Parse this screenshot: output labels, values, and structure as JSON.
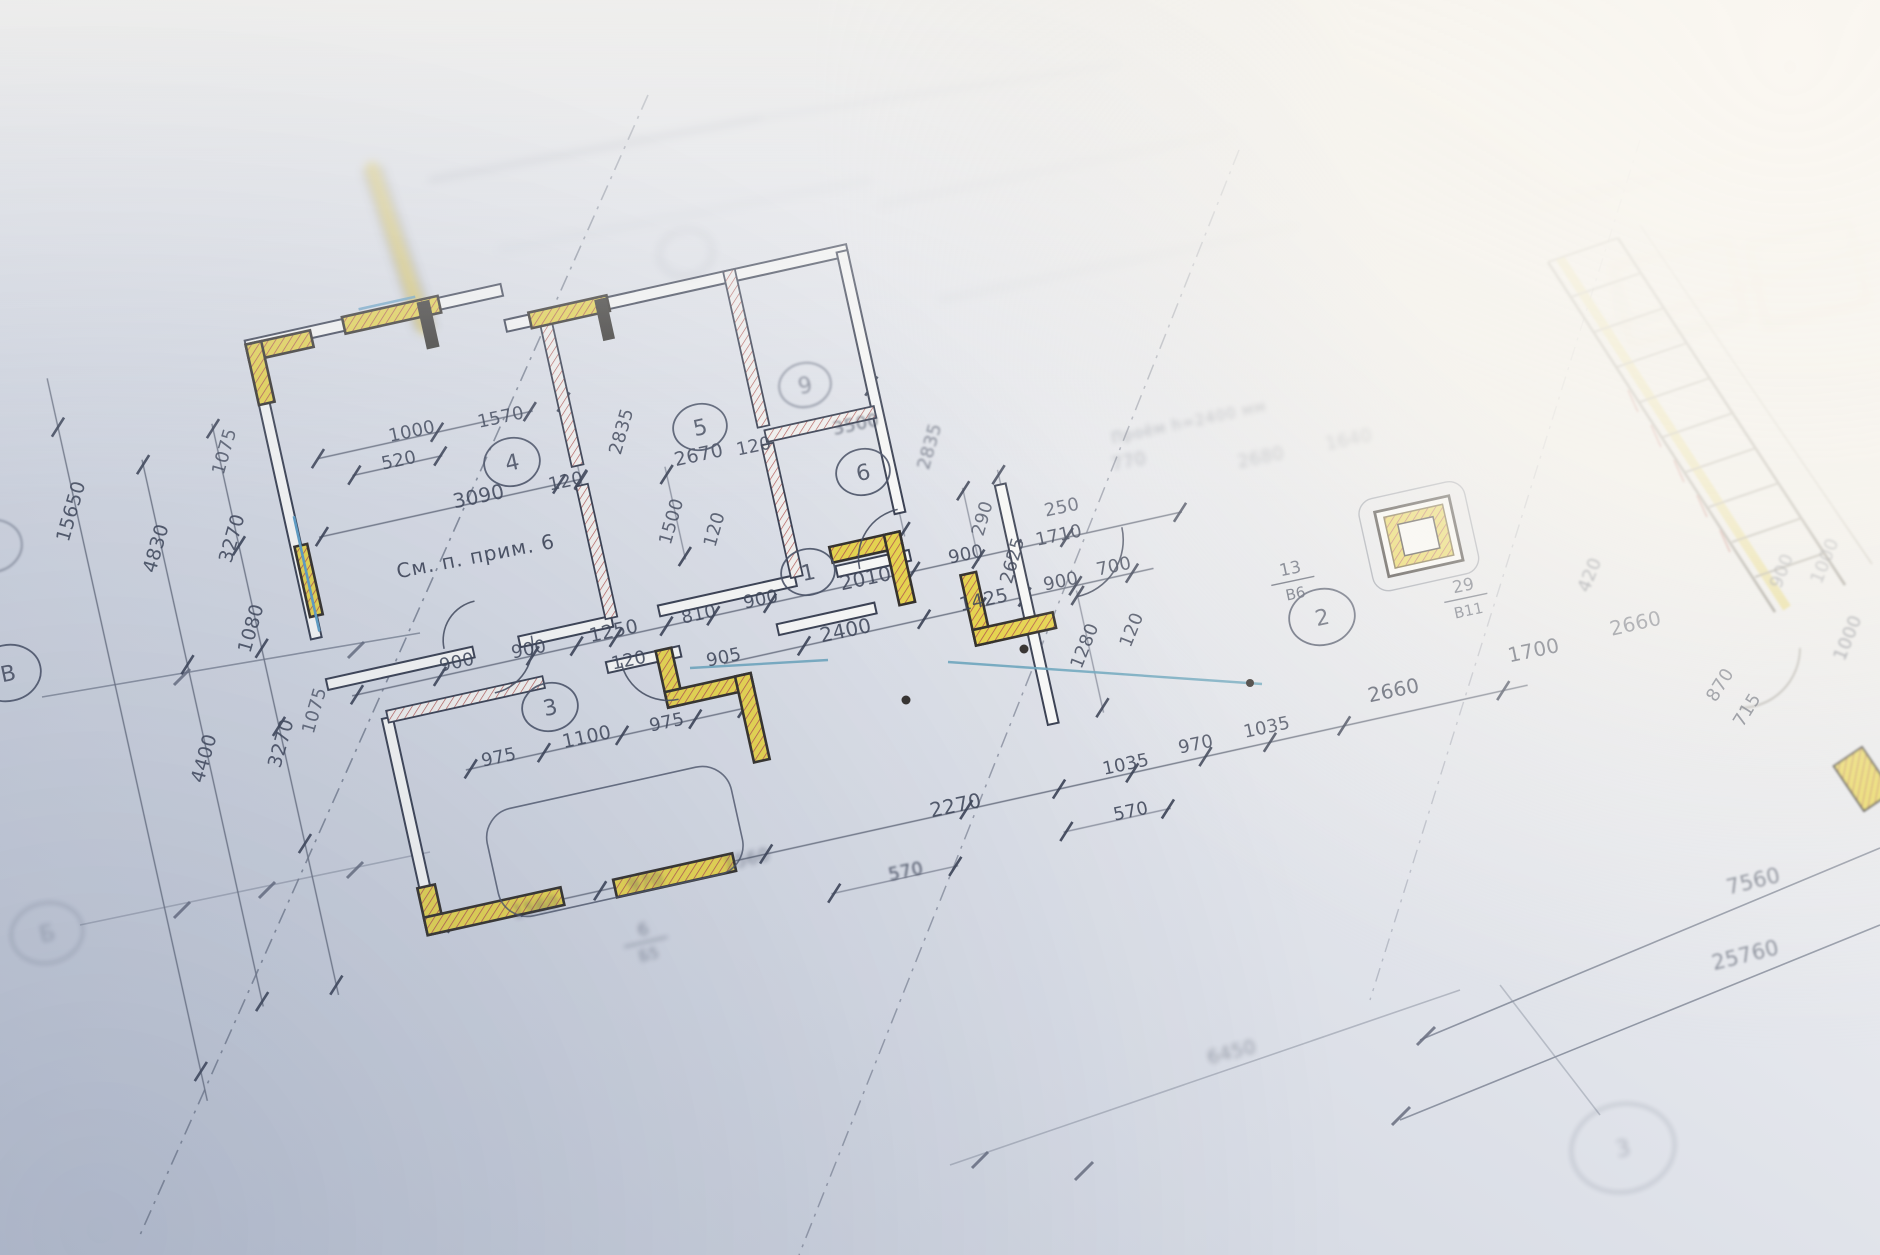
{
  "palette": {
    "paper_dark": "#c3c9d6",
    "paper_mid": "#dde0e8",
    "paper_light": "#f6f4ee",
    "line_dark": "#353b4c",
    "line_mid": "#5a6274",
    "wall_yellow": "#ead74e",
    "hatch_red": "#b3524d",
    "window_blue": "#5e9fc6",
    "accent_tan": "#c8a85a"
  },
  "plan": {
    "dimension_labels": [
      {
        "t": "1000",
        "x": 413,
        "y": 437,
        "r": -12
      },
      {
        "t": "1570",
        "x": 502,
        "y": 423,
        "r": -12
      },
      {
        "t": "520",
        "x": 400,
        "y": 466,
        "r": -12
      },
      {
        "t": "3090",
        "x": 480,
        "y": 503,
        "r": -12,
        "s": 20
      },
      {
        "t": "120",
        "x": 567,
        "y": 487,
        "r": -12
      },
      {
        "t": "2670",
        "x": 700,
        "y": 461,
        "r": -12,
        "s": 19
      },
      {
        "t": "120",
        "x": 755,
        "y": 452,
        "r": -12
      },
      {
        "t": "3500",
        "x": 857,
        "y": 430,
        "r": -12,
        "o": 0.7,
        "b": 1
      },
      {
        "t": "2835",
        "x": 627,
        "y": 433,
        "r": -74
      },
      {
        "t": "2835",
        "x": 935,
        "y": 448,
        "r": -74,
        "o": 0.6,
        "b": 1
      },
      {
        "t": "1500",
        "x": 677,
        "y": 523,
        "r": -74,
        "o": 0.8
      },
      {
        "t": "120",
        "x": 720,
        "y": 531,
        "r": -74,
        "o": 0.8
      },
      {
        "t": "2010",
        "x": 867,
        "y": 585,
        "r": -12,
        "s": 20
      },
      {
        "t": "900",
        "x": 762,
        "y": 605,
        "r": -12
      },
      {
        "t": "810",
        "x": 700,
        "y": 620,
        "r": -12
      },
      {
        "t": "1250",
        "x": 615,
        "y": 637,
        "r": -12,
        "s": 19
      },
      {
        "t": "120",
        "x": 630,
        "y": 666,
        "r": -12
      },
      {
        "t": "905",
        "x": 725,
        "y": 663,
        "r": -12
      },
      {
        "t": "2400",
        "x": 847,
        "y": 637,
        "r": -12,
        "s": 20
      },
      {
        "t": "900",
        "x": 458,
        "y": 668,
        "r": -12
      },
      {
        "t": "900",
        "x": 530,
        "y": 655,
        "r": -12
      },
      {
        "t": "975",
        "x": 500,
        "y": 763,
        "r": -12
      },
      {
        "t": "1100",
        "x": 588,
        "y": 743,
        "r": -12,
        "s": 19
      },
      {
        "t": "975",
        "x": 668,
        "y": 728,
        "r": -12
      },
      {
        "t": "250",
        "x": 1063,
        "y": 513,
        "r": -12,
        "o": 0.75
      },
      {
        "t": "1710",
        "x": 1060,
        "y": 541,
        "r": -12
      },
      {
        "t": "900",
        "x": 967,
        "y": 560,
        "r": -12
      },
      {
        "t": "2625",
        "x": 1018,
        "y": 562,
        "r": -74
      },
      {
        "t": "290",
        "x": 988,
        "y": 520,
        "r": -74,
        "o": 0.75
      },
      {
        "t": "1425",
        "x": 985,
        "y": 606,
        "r": -12,
        "s": 19
      },
      {
        "t": "900",
        "x": 1062,
        "y": 587,
        "r": -12
      },
      {
        "t": "700",
        "x": 1115,
        "y": 572,
        "r": -12
      },
      {
        "t": "1280",
        "x": 1090,
        "y": 648,
        "r": -68
      },
      {
        "t": "120",
        "x": 1137,
        "y": 632,
        "r": -68
      },
      {
        "t": "2660",
        "x": 1395,
        "y": 697,
        "r": -12,
        "s": 20
      },
      {
        "t": "1700",
        "x": 1535,
        "y": 657,
        "r": -12,
        "s": 20
      },
      {
        "t": "1035",
        "x": 1268,
        "y": 733,
        "r": -12
      },
      {
        "t": "1035",
        "x": 1127,
        "y": 770,
        "r": -12
      },
      {
        "t": "970",
        "x": 1197,
        "y": 750,
        "r": -12
      },
      {
        "t": "2270",
        "x": 957,
        "y": 812,
        "r": -12,
        "s": 20
      },
      {
        "t": "570",
        "x": 1132,
        "y": 817,
        "r": -12
      },
      {
        "t": "570",
        "x": 907,
        "y": 877,
        "r": -12,
        "b": 1
      },
      {
        "t": "1560",
        "x": 537,
        "y": 913,
        "r": -13,
        "b": 2,
        "o": 0.6
      },
      {
        "t": "970",
        "x": 647,
        "y": 888,
        "r": -13,
        "b": 2,
        "o": 0.6
      },
      {
        "t": "1560",
        "x": 748,
        "y": 865,
        "r": -13,
        "b": 2,
        "o": 0.6
      },
      {
        "t": "420",
        "x": 1595,
        "y": 577,
        "r": -68,
        "o": 0.7,
        "b": 1
      },
      {
        "t": "2660",
        "x": 1637,
        "y": 630,
        "r": -13,
        "s": 20,
        "o": 0.8
      },
      {
        "t": "900",
        "x": 1787,
        "y": 573,
        "r": -68,
        "o": 0.7,
        "b": 1
      },
      {
        "t": "1000",
        "x": 1830,
        "y": 563,
        "r": -68,
        "o": 0.65,
        "b": 1
      },
      {
        "t": "1000",
        "x": 1853,
        "y": 640,
        "r": -68,
        "o": 0.7,
        "b": 1
      },
      {
        "t": "870",
        "x": 1725,
        "y": 688,
        "r": -58,
        "o": 0.8
      },
      {
        "t": "715",
        "x": 1752,
        "y": 713,
        "r": -58,
        "o": 0.8
      },
      {
        "t": "4830",
        "x": 162,
        "y": 550,
        "r": -74,
        "s": 19
      },
      {
        "t": "3270",
        "x": 238,
        "y": 540,
        "r": -74,
        "s": 19
      },
      {
        "t": "1080",
        "x": 257,
        "y": 630,
        "r": -74,
        "s": 19
      },
      {
        "t": "3270",
        "x": 287,
        "y": 745,
        "r": -74,
        "s": 19
      },
      {
        "t": "4400",
        "x": 210,
        "y": 760,
        "r": -74,
        "s": 19
      },
      {
        "t": "1075",
        "x": 230,
        "y": 453,
        "r": -74,
        "o": 0.8
      },
      {
        "t": "1075",
        "x": 320,
        "y": 712,
        "r": -74,
        "o": 0.75
      },
      {
        "t": "15650",
        "x": 77,
        "y": 513,
        "r": -74,
        "s": 19
      },
      {
        "t": "7560",
        "x": 1755,
        "y": 888,
        "r": -14,
        "s": 21,
        "o": 0.6,
        "b": 1
      },
      {
        "t": "25760",
        "x": 1747,
        "y": 962,
        "r": -14,
        "s": 21,
        "o": 0.55,
        "b": 1
      },
      {
        "t": "6450",
        "x": 1233,
        "y": 1058,
        "r": -14,
        "s": 19,
        "o": 0.4,
        "b": 2
      },
      {
        "t": "770",
        "x": 1130,
        "y": 467,
        "r": -12,
        "o": 0.35,
        "b": 2
      },
      {
        "t": "2680",
        "x": 1262,
        "y": 463,
        "r": -12,
        "o": 0.35,
        "b": 2
      },
      {
        "t": "1640",
        "x": 1350,
        "y": 445,
        "r": -12,
        "o": 0.35,
        "b": 2
      }
    ],
    "fraction_labels": [
      {
        "top": "13",
        "bottom": "В6",
        "x": 1292,
        "y": 577,
        "r": -12
      },
      {
        "top": "29",
        "bottom": "В11",
        "x": 1465,
        "y": 594,
        "r": -12
      },
      {
        "top": "6",
        "bottom": "Б5",
        "x": 645,
        "y": 938,
        "r": -13,
        "o": 0.55,
        "b": 2
      }
    ],
    "note_labels": [
      {
        "t": "См. п. прим. 6",
        "x": 477,
        "y": 563,
        "r": -11,
        "s": 20
      },
      {
        "t": "Проём h=2400 мм",
        "x": 1190,
        "y": 427,
        "r": -12,
        "s": 15,
        "o": 0.4,
        "b": 2
      }
    ],
    "room_circles": [
      {
        "t": "4",
        "x": 512,
        "y": 462,
        "rx": 28,
        "ry": 24
      },
      {
        "t": "5",
        "x": 700,
        "y": 427,
        "rx": 27,
        "ry": 23
      },
      {
        "t": "9",
        "x": 805,
        "y": 385,
        "rx": 26,
        "ry": 22,
        "o": 0.55,
        "b": 1
      },
      {
        "t": "6",
        "x": 863,
        "y": 472,
        "rx": 27,
        "ry": 23
      },
      {
        "t": "1",
        "x": 808,
        "y": 572,
        "rx": 27,
        "ry": 23
      },
      {
        "t": "3",
        "x": 550,
        "y": 707,
        "rx": 28,
        "ry": 24
      },
      {
        "t": "2",
        "x": 1322,
        "y": 617,
        "rx": 33,
        "ry": 28
      }
    ],
    "axis_circles": [
      {
        "t": "В",
        "x": 8,
        "y": 673,
        "rx": 33,
        "ry": 28
      },
      {
        "t": "Б",
        "x": 47,
        "y": 933,
        "rx": 36,
        "ry": 30,
        "o": 0.35,
        "b": 2
      },
      {
        "t": "3",
        "x": 1623,
        "y": 1148,
        "rx": 52,
        "ry": 44,
        "o": 0.3,
        "b": 2
      },
      {
        "t": "",
        "x": 686,
        "y": 253,
        "rx": 27,
        "ry": 23,
        "o": 0.3,
        "b": 3
      },
      {
        "t": "",
        "x": -8,
        "y": 546,
        "rx": 30,
        "ry": 26,
        "o": 0.5,
        "b": 1
      }
    ]
  }
}
